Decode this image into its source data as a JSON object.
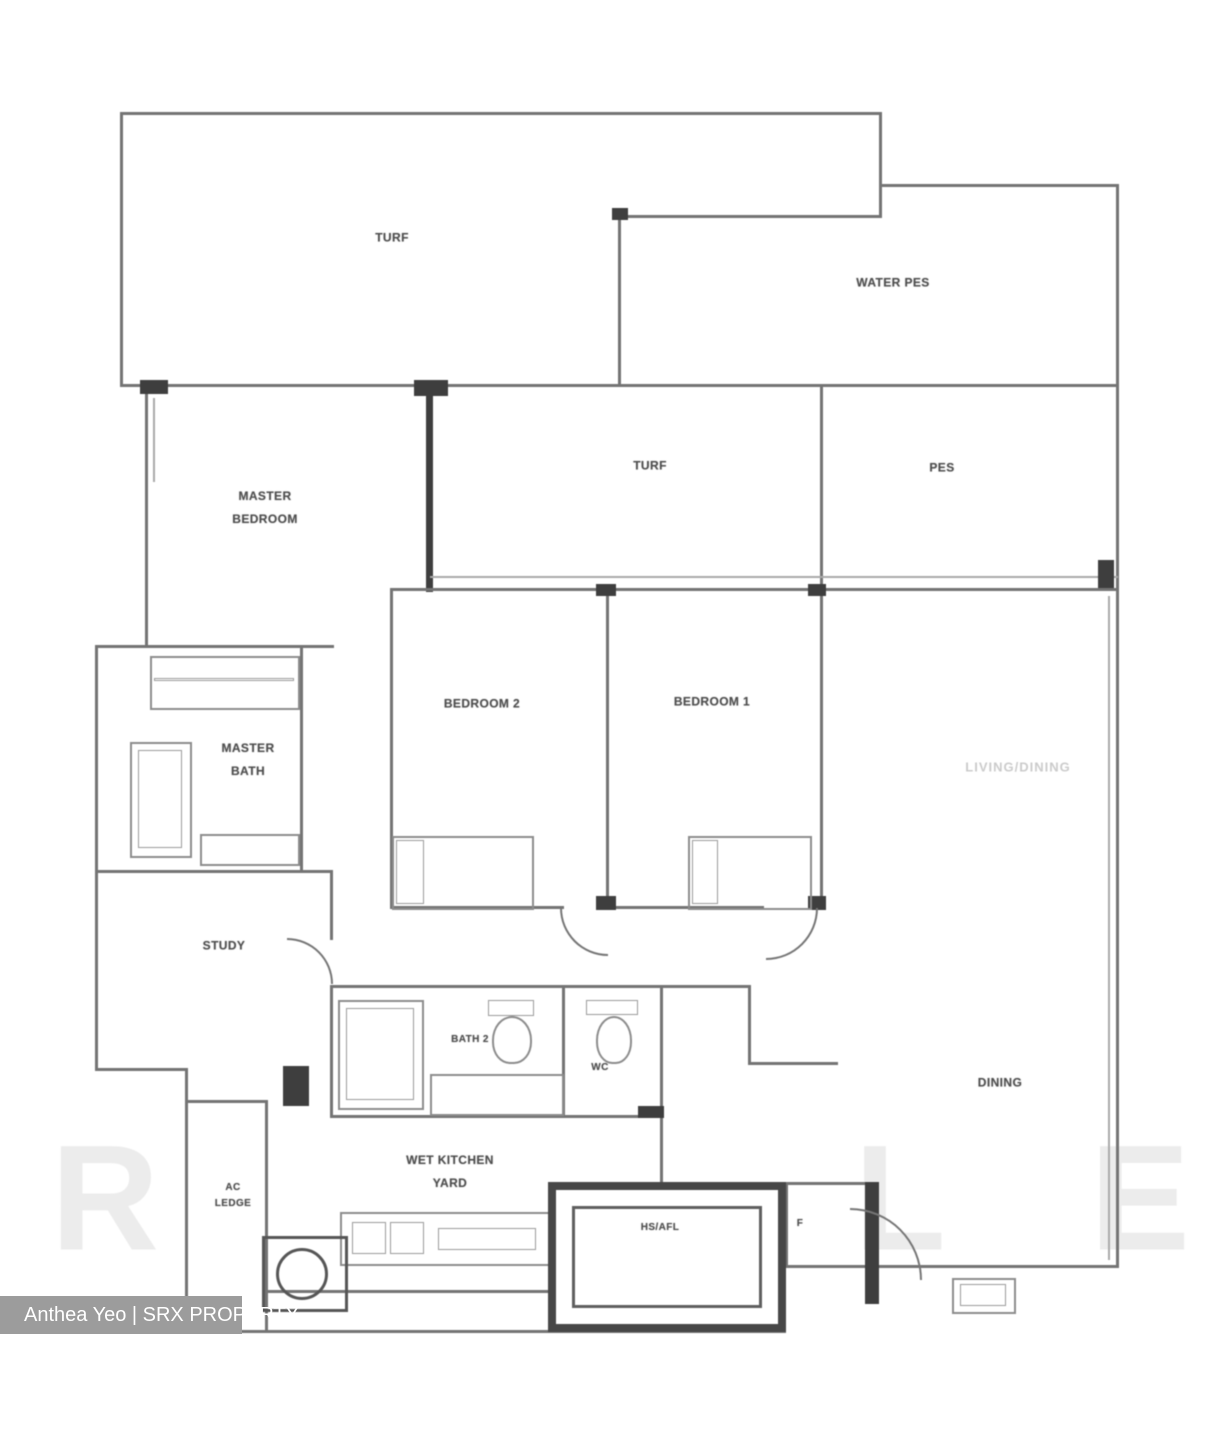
{
  "colors": {
    "wall": "#747474",
    "wall_dark": "#3e3e3e",
    "label": "#4e4e4e",
    "faint_label": "#cbcbcb",
    "credit_band_bg": "#9c9c9c",
    "credit_band_text": "#ffffff"
  },
  "rooms": {
    "turf_top": "TURF",
    "water_pes": "WATER PES",
    "master_bedroom": "MASTER\nBEDROOM",
    "turf_mid": "TURF",
    "pes": "PES",
    "bedroom_2": "BEDROOM 2",
    "bedroom_1": "BEDROOM 1",
    "living_dining": "LIVING/DINING",
    "master_bath": "MASTER\nBATH",
    "study": "STUDY",
    "bath_2": "BATH 2",
    "wc": "WC",
    "dining": "DINING",
    "wet_kitchen_yard": "WET KITCHEN\nYARD",
    "ac_ledge": "AC\nLEDGE",
    "hs_afl": "HS/AFL",
    "fridge": "F"
  },
  "watermark": {
    "credit": "Anthea Yeo | SRX PROPERTY",
    "letter_r": "R",
    "letter_l": "L",
    "letter_e": "E"
  }
}
